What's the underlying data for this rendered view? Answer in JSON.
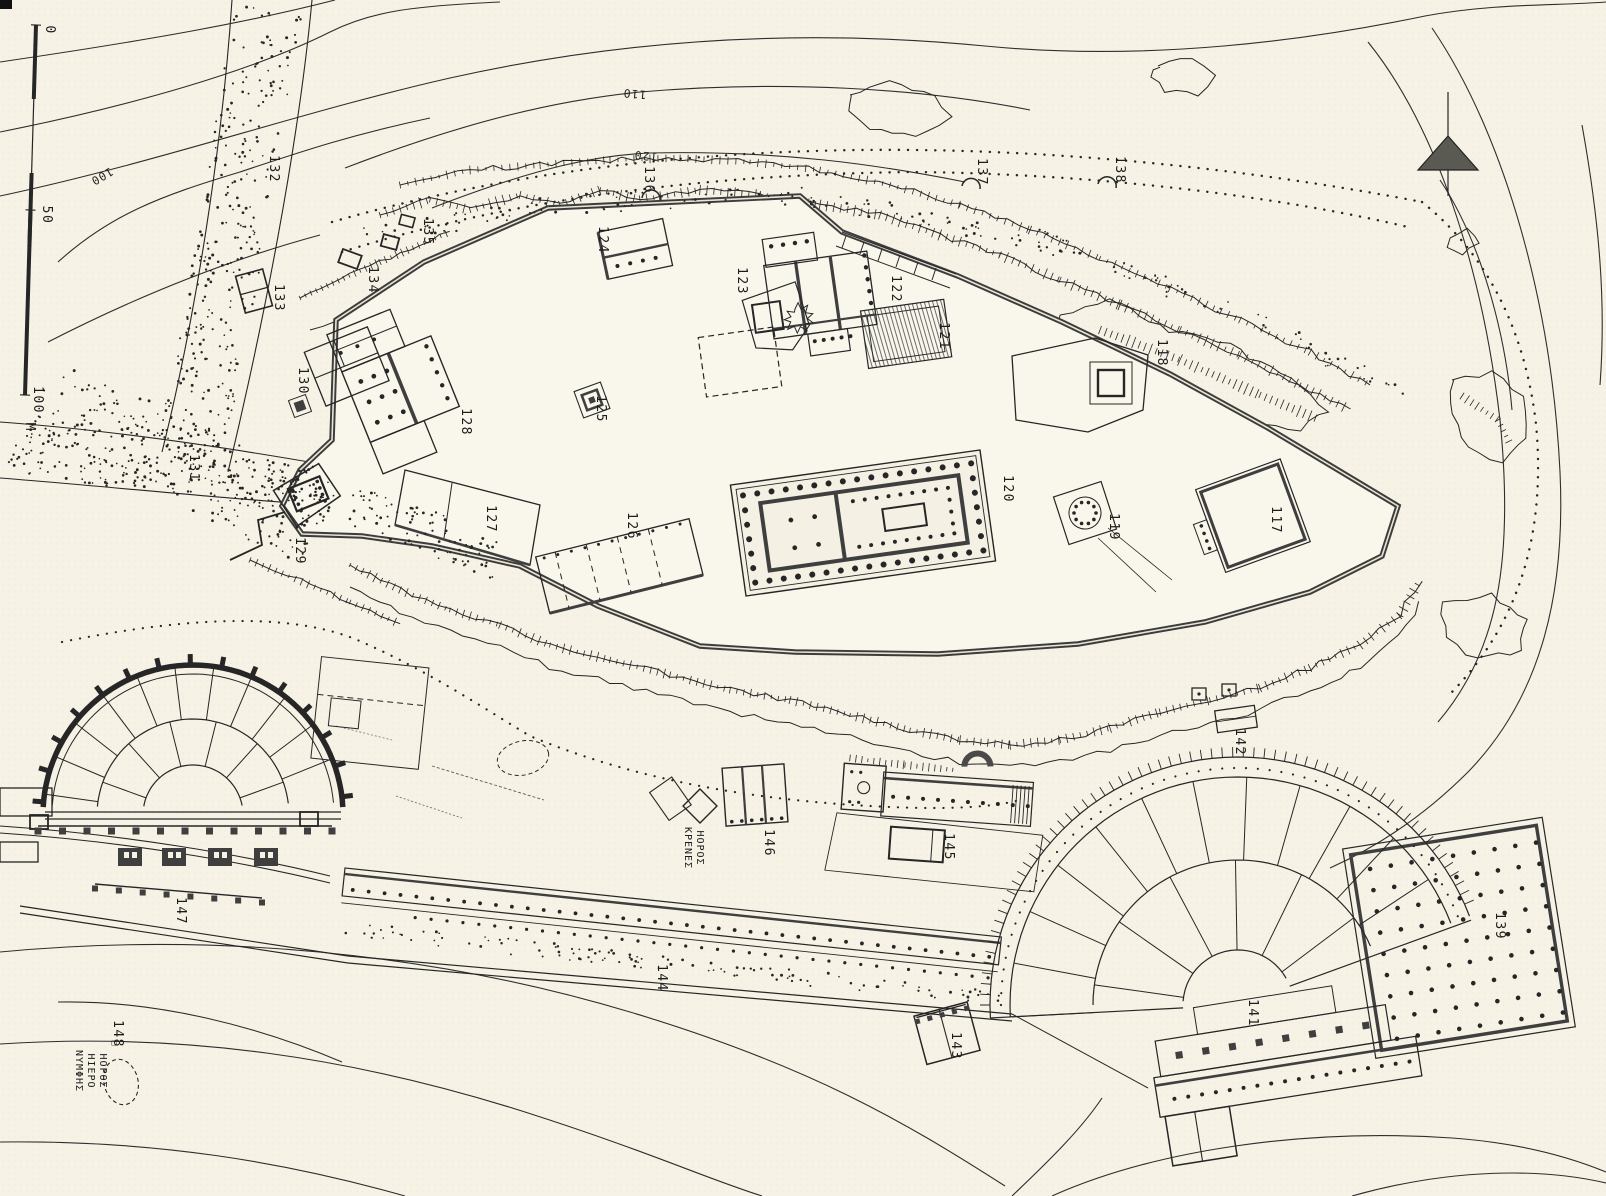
{
  "colors": {
    "paper": "#f6f2e6",
    "plateau": "#f9f6ec",
    "ink": "#262626",
    "wall": "#3c3c3c"
  },
  "scale_bar": {
    "tick_labels": [
      "0",
      "50",
      "100"
    ],
    "unit_label": "M."
  },
  "contour_labels": [
    {
      "text": "100",
      "x": 100,
      "y": 173,
      "rot": 150
    },
    {
      "text": "110",
      "x": 635,
      "y": 90,
      "rot": 185
    },
    {
      "text": "120",
      "x": 646,
      "y": 152,
      "rot": 185
    }
  ],
  "building_labels": [
    {
      "n": "117",
      "x": 1272,
      "y": 520
    },
    {
      "n": "118",
      "x": 1158,
      "y": 353
    },
    {
      "n": "119",
      "x": 1110,
      "y": 527
    },
    {
      "n": "120",
      "x": 1004,
      "y": 489
    },
    {
      "n": "121",
      "x": 940,
      "y": 336
    },
    {
      "n": "122",
      "x": 892,
      "y": 289
    },
    {
      "n": "123",
      "x": 738,
      "y": 281
    },
    {
      "n": "124",
      "x": 599,
      "y": 240
    },
    {
      "n": "125",
      "x": 597,
      "y": 409
    },
    {
      "n": "126",
      "x": 628,
      "y": 526
    },
    {
      "n": "127",
      "x": 487,
      "y": 519
    },
    {
      "n": "128",
      "x": 462,
      "y": 422
    },
    {
      "n": "129",
      "x": 296,
      "y": 551
    },
    {
      "n": "130",
      "x": 299,
      "y": 381
    },
    {
      "n": "131",
      "x": 190,
      "y": 468
    },
    {
      "n": "132",
      "x": 270,
      "y": 169
    },
    {
      "n": "133",
      "x": 275,
      "y": 298
    },
    {
      "n": "134",
      "x": 369,
      "y": 280
    },
    {
      "n": "135",
      "x": 424,
      "y": 232
    },
    {
      "n": "136",
      "x": 645,
      "y": 180
    },
    {
      "n": "137",
      "x": 978,
      "y": 172
    },
    {
      "n": "138",
      "x": 1116,
      "y": 170
    },
    {
      "n": "139",
      "x": 1496,
      "y": 926
    },
    {
      "n": "141",
      "x": 1249,
      "y": 1013
    },
    {
      "n": "142",
      "x": 1236,
      "y": 742
    },
    {
      "n": "143",
      "x": 952,
      "y": 1046
    },
    {
      "n": "144",
      "x": 658,
      "y": 978
    },
    {
      "n": "145",
      "x": 945,
      "y": 847
    },
    {
      "n": "146",
      "x": 765,
      "y": 843
    },
    {
      "n": "147",
      "x": 177,
      "y": 911
    },
    {
      "n": "148",
      "x": 114,
      "y": 1034
    }
  ],
  "greek_labels": [
    {
      "lines": [
        "ΗΟΡΟΣ",
        "ΚΡΕΝΕΣ"
      ],
      "x": 697,
      "y": 848
    },
    {
      "lines": [
        "ΗΟΡΟΣ",
        "ΗΙΕΡΟ",
        "ΝΥΜΦΗΣ"
      ],
      "x": 100,
      "y": 1071,
      "marker": "□"
    }
  ]
}
